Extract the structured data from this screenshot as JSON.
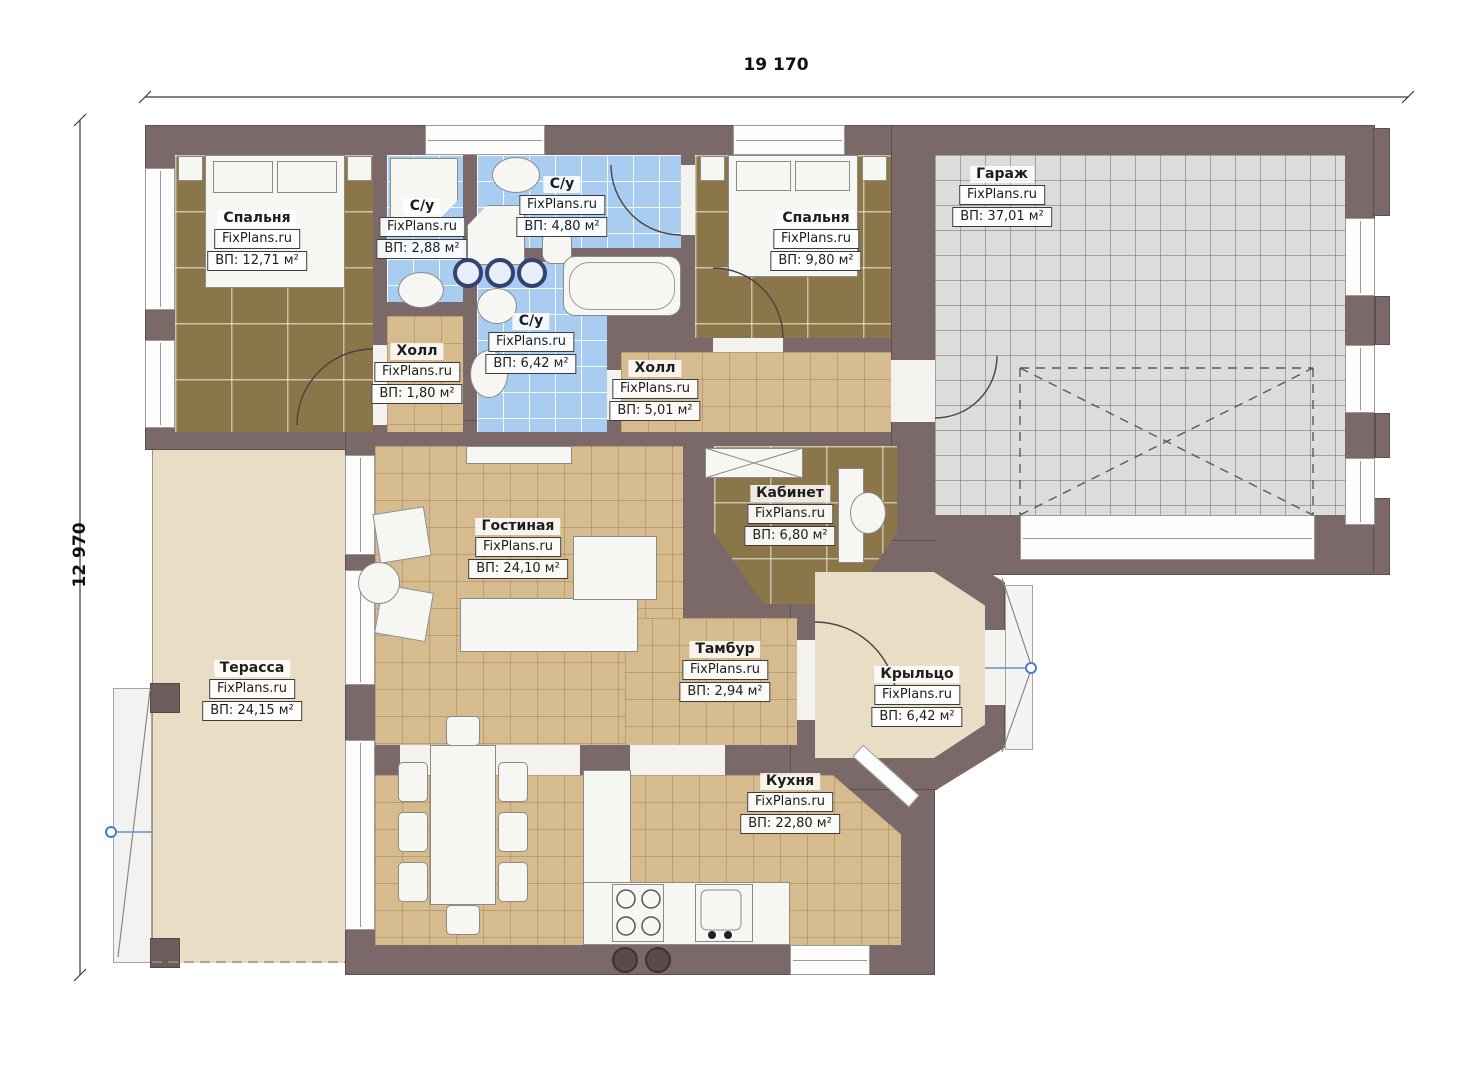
{
  "plan": {
    "dimensions": {
      "width_mm": "19 170",
      "height_mm": "12 970"
    },
    "watermark": "FixPlans.ru",
    "rooms": [
      {
        "name": "Спальня",
        "area": "ВП: 12,71 м²"
      },
      {
        "name": "С/у",
        "area": "ВП: 2,88 м²"
      },
      {
        "name": "С/у",
        "area": "ВП: 4,80 м²"
      },
      {
        "name": "Спальня",
        "area": "ВП: 9,80 м²"
      },
      {
        "name": "Гараж",
        "area": "ВП: 37,01 м²"
      },
      {
        "name": "Холл",
        "area": "ВП: 1,80 м²"
      },
      {
        "name": "С/у",
        "area": "ВП: 6,42 м²"
      },
      {
        "name": "Холл",
        "area": "ВП: 5,01 м²"
      },
      {
        "name": "Кабинет",
        "area": "ВП: 6,80 м²"
      },
      {
        "name": "Гостиная",
        "area": "ВП: 24,10 м²"
      },
      {
        "name": "Терасса",
        "area": "ВП: 24,15 м²"
      },
      {
        "name": "Тамбур",
        "area": "ВП: 2,94 м²"
      },
      {
        "name": "Крыльцо",
        "area": "ВП: 6,42 м²"
      },
      {
        "name": "Кухня",
        "area": "ВП: 22,80 м²"
      }
    ],
    "colors": {
      "wall": "#7b6969",
      "floor_wood": "#8a7648",
      "floor_tile_tan": "#d5bb8d",
      "floor_tile_blue": "#a8cdf0",
      "floor_garage": "#dcdcda",
      "terrace": "#e9ddc5",
      "marker_blue": "#4a7fc1"
    }
  }
}
